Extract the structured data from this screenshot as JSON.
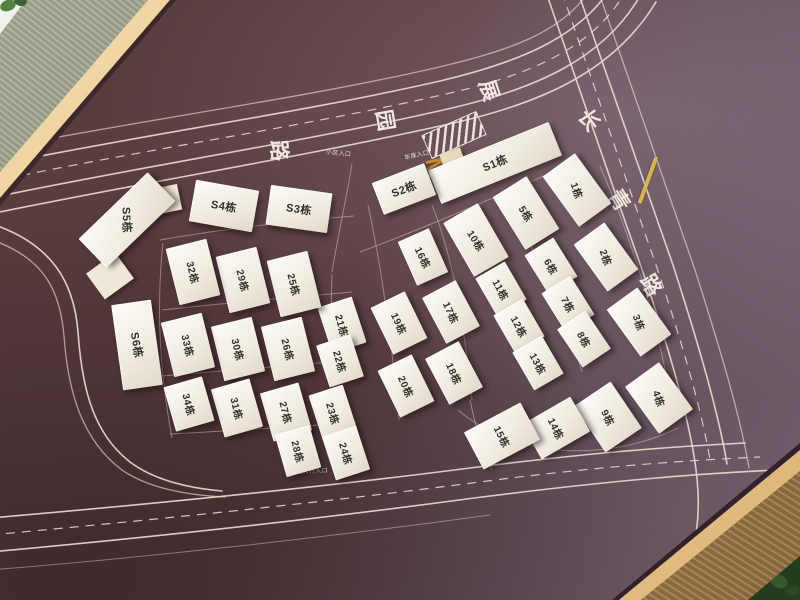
{
  "roads": {
    "top_road": {
      "name": "展园路",
      "chars": [
        "展",
        "园",
        "路"
      ]
    },
    "right_road": {
      "name": "长青路",
      "chars": [
        "长",
        "青",
        "路"
      ]
    }
  },
  "markers": {
    "garage_m_label": "M",
    "main_entrance_label": "小区入口",
    "garage_entrance_label": "车库入口",
    "pedestrian_entrance_label": "小区人行入口"
  },
  "colors": {
    "board_dark": "#54383a",
    "board_light": "#75646f",
    "road_line": "#eadcd3",
    "building_fill": "#f5f2ea",
    "frame_gold": "#d9a967",
    "frame_metal": "#8e947f",
    "frame_bronze": "#a8824f",
    "accent_yellow": "#d8b64a"
  },
  "buildings": [
    {
      "label": "S1栋"
    },
    {
      "label": "S2栋"
    },
    {
      "label": "S3栋"
    },
    {
      "label": "S4栋"
    },
    {
      "label": "S5栋"
    },
    {
      "label": "S6栋"
    },
    {
      "label": "1栋"
    },
    {
      "label": "2栋"
    },
    {
      "label": "3栋"
    },
    {
      "label": "4栋"
    },
    {
      "label": "5栋"
    },
    {
      "label": "6栋"
    },
    {
      "label": "7栋"
    },
    {
      "label": "8栋"
    },
    {
      "label": "9栋"
    },
    {
      "label": "10栋"
    },
    {
      "label": "11栋"
    },
    {
      "label": "12栋"
    },
    {
      "label": "13栋"
    },
    {
      "label": "14栋"
    },
    {
      "label": "15栋"
    },
    {
      "label": "16栋"
    },
    {
      "label": "17栋"
    },
    {
      "label": "18栋"
    },
    {
      "label": "19栋"
    },
    {
      "label": "20栋"
    },
    {
      "label": "21栋"
    },
    {
      "label": "22栋"
    },
    {
      "label": "23栋"
    },
    {
      "label": "24栋"
    },
    {
      "label": "25栋"
    },
    {
      "label": "26栋"
    },
    {
      "label": "27栋"
    },
    {
      "label": "28栋"
    },
    {
      "label": "29栋"
    },
    {
      "label": "30栋"
    },
    {
      "label": "31栋"
    },
    {
      "label": "32栋"
    },
    {
      "label": "33栋"
    },
    {
      "label": "34栋"
    }
  ]
}
